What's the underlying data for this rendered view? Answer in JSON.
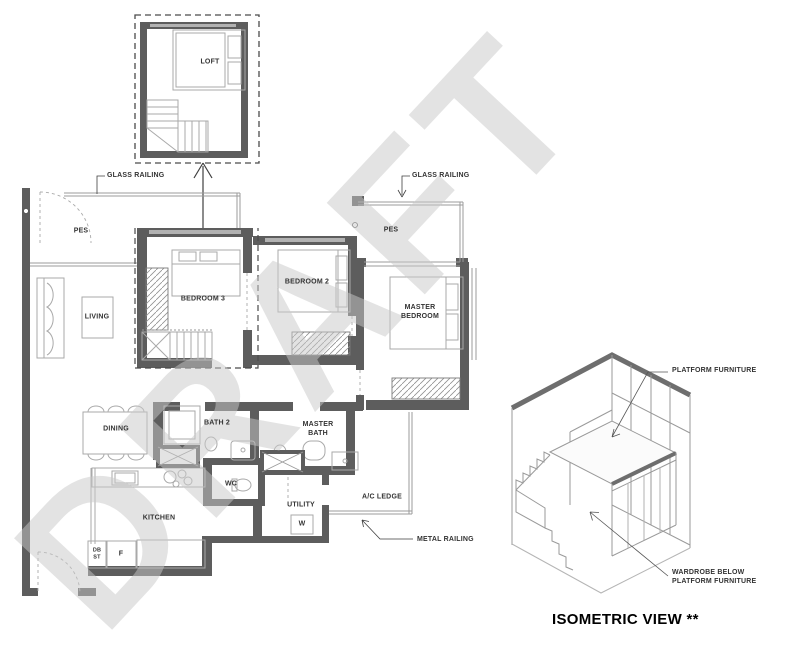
{
  "watermark": "DRAFT",
  "floor_plan": {
    "loft": {
      "label": "LOFT"
    },
    "rooms": {
      "pes_left": "PES",
      "pes_right": "PES",
      "living": "LIVING",
      "bedroom3": "BEDROOM 3",
      "bedroom2": "BEDROOM 2",
      "master_bedroom": {
        "line1": "MASTER",
        "line2": "BEDROOM"
      },
      "dining": "DINING",
      "bath2": "BATH 2",
      "wc": "WC",
      "master_bath": {
        "line1": "MASTER",
        "line2": "BATH"
      },
      "kitchen": "KITCHEN",
      "utility": "UTILITY",
      "ac_ledge": "A/C LEDGE"
    },
    "fixtures": {
      "washer": "W",
      "fridge": "F",
      "db": {
        "line1": "DB",
        "line2": "ST"
      }
    },
    "callouts": {
      "glass_railing_left": "GLASS RAILING",
      "glass_railing_right": "GLASS RAILING",
      "metal_railing": "METAL RAILING"
    }
  },
  "isometric": {
    "title": "ISOMETRIC VIEW **",
    "callouts": {
      "platform_furniture": "PLATFORM FURNITURE",
      "wardrobe_below": {
        "line1": "WARDROBE BELOW",
        "line2": "PLATFORM FURNITURE"
      }
    }
  },
  "colors": {
    "wall": "#5d5d5d",
    "thin_line": "#9b9b9b",
    "label": "#333333",
    "watermark": "#c9c9c9",
    "background": "#ffffff"
  }
}
